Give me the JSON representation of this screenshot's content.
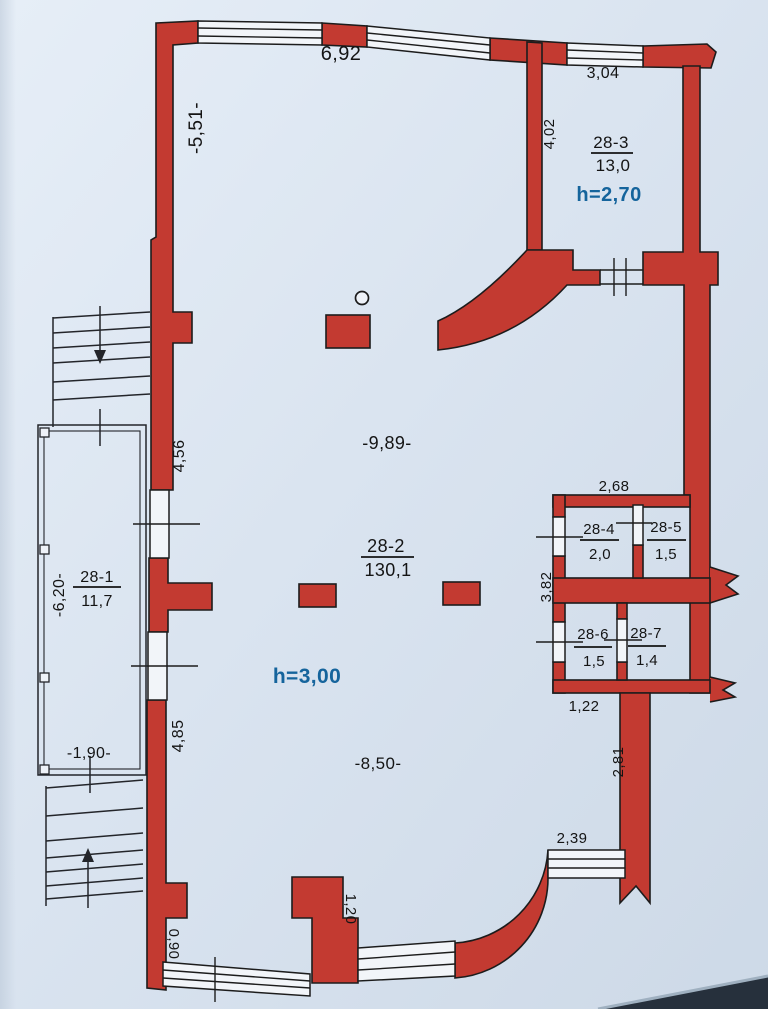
{
  "plan": {
    "title": "apartment floor plan 28",
    "rooms": {
      "r28_1": {
        "number": "28-1",
        "area": "11,7"
      },
      "r28_2": {
        "number": "28-2",
        "area": "130,1",
        "height": "h=3,00"
      },
      "r28_3": {
        "number": "28-3",
        "area": "13,0",
        "height": "h=2,70"
      },
      "r28_4": {
        "number": "28-4",
        "area": "2,0"
      },
      "r28_5": {
        "number": "28-5",
        "area": "1,5"
      },
      "r28_6": {
        "number": "28-6",
        "area": "1,5"
      },
      "r28_7": {
        "number": "28-7",
        "area": "1,4"
      }
    },
    "dimensions": {
      "top_left": "6,92",
      "top_right": "3,04",
      "left_upper": "-5,51-",
      "room3_left": "4,02",
      "hall_upper": "-9,89-",
      "left_mid": "4,56",
      "balcony_left": "-6,20-",
      "balcony_bottom": "-1,90-",
      "left_lower": "4,85",
      "hall_lower": "-8,50-",
      "block_top": "2,68",
      "block_left": "3,82",
      "block_bottom": "1,22",
      "right_lower": "2,81",
      "bottom_right": "2,39",
      "bottom_mid": "1,20",
      "bottom_left": "0,90"
    },
    "colors": {
      "wall": "#c33a31",
      "line": "#1c1c1c",
      "accent_text": "#15649c",
      "text": "#141414",
      "paper": "#dbe4f0"
    }
  }
}
